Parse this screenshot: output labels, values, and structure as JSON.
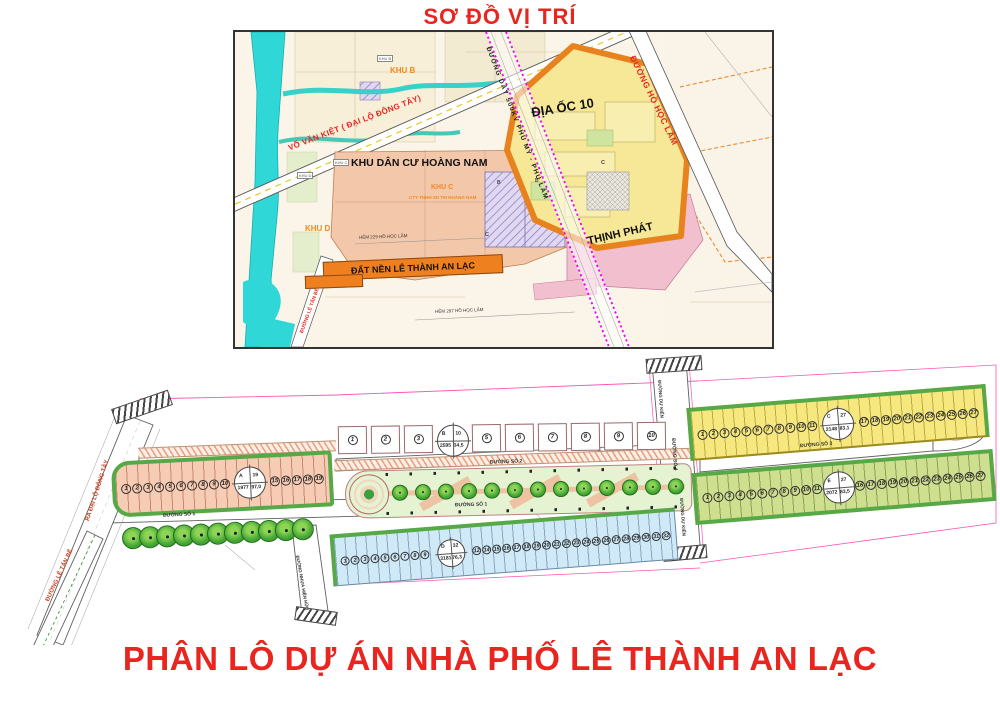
{
  "colors": {
    "title_red": "#e8251f",
    "banner_orange": "#ef8020",
    "block_green": "#57a847",
    "power_magenta": "#f000f0"
  },
  "location_map": {
    "title": "SƠ ĐỒ VỊ TRÍ",
    "areas": {
      "khu_b": "KHU B",
      "khu_b_box": "KHU B",
      "khu_c": "KHU C",
      "khu_c_company": "CTY TNHH XD TM HOÀNG NAM",
      "khu_d": "KHU D",
      "khu_d_box": "KHU D",
      "hoang_nam": "KHU DÂN CƯ HOÀNG NAM",
      "dia_oc_10": "ĐỊA ỐC 10",
      "dat_nen": "ĐẤT NỀN LÊ THÀNH AN LẠC",
      "thinh_phat": "THỊNH PHÁT",
      "block_b": "B",
      "block_b2": "B'",
      "block_c_salmon": "C",
      "block_c_yellow": "C"
    },
    "roads": {
      "vo_van_kiet": "VÕ VĂN KIỆT ( ĐẠI LỘ ĐÔNG TÂY)",
      "power_line": "ĐƯỜNG DÂY 500KV PHÚ MỸ - PHÚ LÂM",
      "ho_hoc_lam": "ĐƯỜNG HỒ HỌC LÃM",
      "le_tan_be": "ĐƯỜNG LÊ TẤN BÊ",
      "hem_229": "HẺM 229 HỒ HỌC LÃM",
      "hem_297": "HẺM 297 HỒ HỌC LÃM"
    }
  },
  "site_plan": {
    "road_labels": {
      "so1_a": "ĐƯỜNG SỐ 1",
      "so1_b": "ĐƯỜNG SỐ 1",
      "so2": "ĐƯỜNG SỐ 2",
      "so3": "ĐƯỜNG SỐ 3",
      "so4": "ĐƯỜNG SỐ 4",
      "du_kien_top": "ĐƯỜNG DỰ KIẾN",
      "du_kien_bottom": "ĐƯỜNG DỰ KIẾN",
      "ra_dai_lo": "RA ĐẠI LỘ ĐÔNG TÂY",
      "le_tan_be": "ĐƯỜNG LÊ TẤN BÊ",
      "nhua_hien_huu": "ĐƯỜNG NHỰA HIỆN HỮU"
    },
    "blocks": {
      "a": {
        "left": [
          1,
          2,
          3,
          4,
          5,
          6,
          7,
          8,
          9,
          10
        ],
        "right": [
          15,
          16,
          17,
          18,
          19
        ],
        "circle": {
          "tl": "A",
          "tr": "19",
          "bl": "1977",
          "br": "97,0"
        }
      },
      "b": {
        "left": [
          1,
          2,
          3
        ],
        "right": [
          5,
          6,
          7,
          8,
          9,
          10
        ],
        "circle": {
          "tl": "B",
          "tr": "10",
          "bl": "2595",
          "br": "34,5"
        }
      },
      "c": {
        "left": [
          1,
          2,
          3,
          4,
          5,
          6,
          7,
          8,
          9,
          10,
          11
        ],
        "right": [
          17,
          18,
          19,
          20,
          21,
          22,
          23,
          24,
          25,
          26,
          27
        ],
        "circle": {
          "tl": "C",
          "tr": "27",
          "bl": "2148",
          "br": "83,1"
        }
      },
      "d": {
        "left": [
          1,
          2,
          3,
          4,
          5,
          6,
          7,
          8,
          9
        ],
        "right": [
          12,
          14,
          15,
          16,
          17,
          18,
          19,
          20,
          21,
          22,
          23,
          24,
          25,
          26,
          27,
          28,
          29,
          30,
          31,
          32
        ],
        "circle": {
          "tl": "D",
          "tr": "32",
          "bl": "3181",
          "br": "76,3"
        }
      },
      "e": {
        "left": [
          1,
          2,
          3,
          4,
          5,
          6,
          7,
          8,
          9,
          10,
          11
        ],
        "right": [
          16,
          17,
          18,
          19,
          20,
          21,
          22,
          23,
          24,
          25,
          26,
          27
        ],
        "circle": {
          "tl": "E",
          "tr": "27",
          "bl": "2072",
          "br": "83,5"
        }
      }
    },
    "street_trees": [
      1,
      2,
      3,
      4,
      5,
      6,
      7,
      8,
      9,
      10,
      11
    ],
    "park_trees": [
      1,
      2,
      3,
      4,
      5,
      6,
      7,
      8,
      9,
      10,
      11,
      12,
      13,
      14
    ]
  },
  "footer": {
    "title": "PHÂN LÔ DỰ ÁN NHÀ PHỐ LÊ THÀNH AN LẠC"
  }
}
